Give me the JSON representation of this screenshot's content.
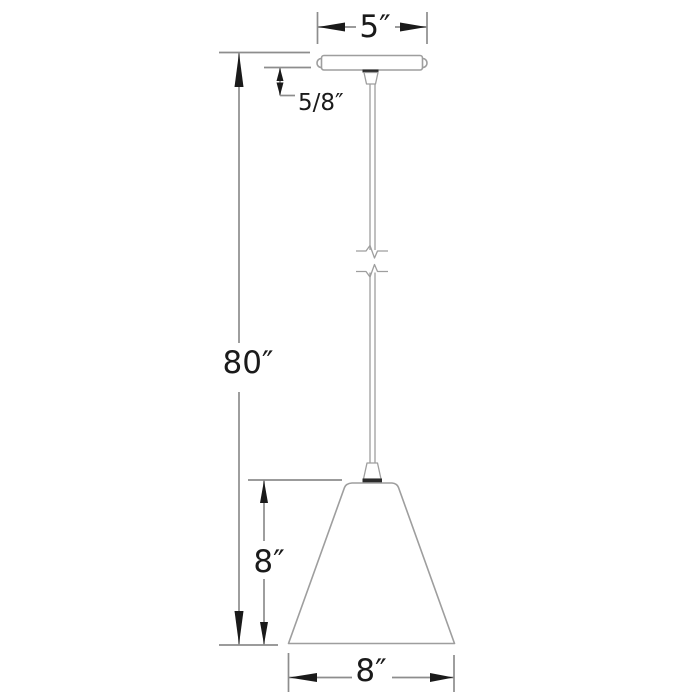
{
  "diagram": {
    "title": "pendant-light-dimension-drawing",
    "colors": {
      "background": "#ffffff",
      "outline": "#9e9e9e",
      "dimension_line": "#8d8d8d",
      "arrow": "#1a1a1a",
      "text": "#1a1a1a",
      "fitting_dark": "#2b2b2b"
    },
    "dimensions": {
      "canopy_width": {
        "label": "5″"
      },
      "canopy_height": {
        "label": "5/8″"
      },
      "overall_height": {
        "label": "80″"
      },
      "shade_height": {
        "label": "8″"
      },
      "shade_width": {
        "label": "8″"
      }
    }
  }
}
